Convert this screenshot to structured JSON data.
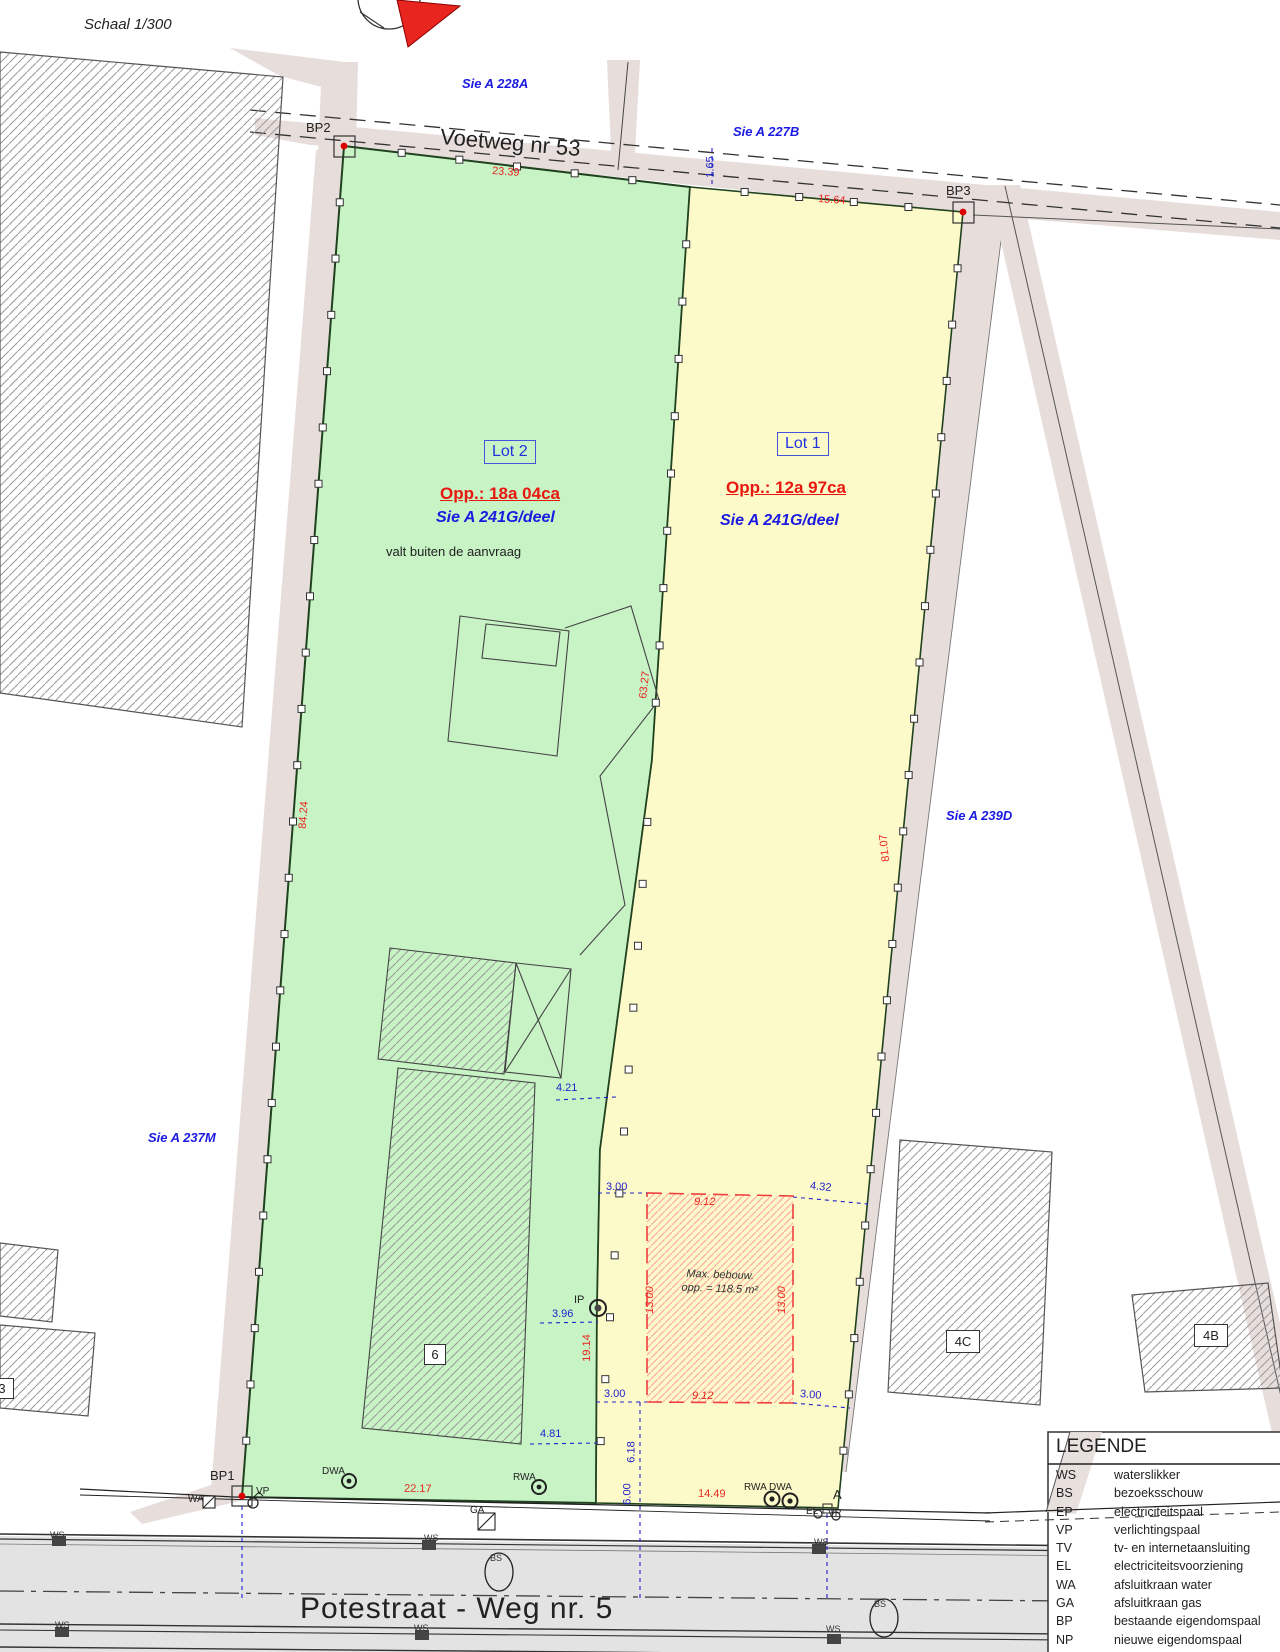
{
  "scale_note": "Schaal 1/300",
  "streets": {
    "voetweg": "Voetweg nr 53",
    "potestraat": "Potestraat - Weg nr. 5"
  },
  "adjacent_parcels": {
    "a228a": "Sie A 228A",
    "a227b": "Sie A 227B",
    "a239d": "Sie A 239D",
    "a237m": "Sie A 237M"
  },
  "lot2": {
    "name": "Lot 2",
    "area": "Opp.: 18a 04ca",
    "cadastre": "Sie A 241G/deel",
    "note": "valt buiten de aanvraag"
  },
  "lot1": {
    "name": "Lot 1",
    "area": "Opp.: 12a 97ca",
    "cadastre": "Sie A 241G/deel"
  },
  "benchmarks": {
    "bp1": "BP1",
    "bp2": "BP2",
    "bp3": "BP3",
    "a": "A",
    "ip": "IP"
  },
  "dims_red": {
    "top_green": "23.39",
    "top_yellow": "15.64",
    "left_edge": "84.24",
    "divider": "63.27",
    "right_edge": "81.07",
    "divider_low": "19.14",
    "box_left": "13.00",
    "box_right": "13.00",
    "box_top": "9.12",
    "box_bottom": "9.12",
    "bottom_green": "22.17",
    "bottom_yellow": "14.49"
  },
  "dims_blue": {
    "gap_165": "1.65",
    "top_left_300": "3.00",
    "top_right_432": "4.32",
    "bot_left_300": "3.00",
    "bot_right_300": "3.00",
    "d396": "3.96",
    "d421": "4.21",
    "d481": "4.81",
    "d618": "6.18",
    "d600": "6.00"
  },
  "max_build": {
    "line1": "Max. bebouw.",
    "line2": "opp. = 118.5 m²"
  },
  "building_labels": {
    "b6": "6",
    "b4c": "4C",
    "b4b": "4B",
    "b3": "3"
  },
  "utilities": {
    "wa": "WA",
    "vp": "VP",
    "dwa": "DWA",
    "rwa": "RWA",
    "ga": "GA",
    "rwadwa": "RWA DWA",
    "el": "EL",
    "vp2": "VP",
    "ws": "WS",
    "bs": "BS"
  },
  "legend": {
    "title": "LEGENDE",
    "rows": [
      {
        "code": "WS",
        "desc": "waterslikker"
      },
      {
        "code": "BS",
        "desc": "bezoeksschouw"
      },
      {
        "code": "EP",
        "desc": "electriciteitspaal"
      },
      {
        "code": "VP",
        "desc": "verlichtingspaal"
      },
      {
        "code": "TV",
        "desc": "tv- en internetaansluiting"
      },
      {
        "code": "EL",
        "desc": "electriciteitsvoorziening"
      },
      {
        "code": "WA",
        "desc": "afsluitkraan water"
      },
      {
        "code": "GA",
        "desc": "afsluitkraan gas"
      },
      {
        "code": "BP",
        "desc": "bestaande eigendomspaal"
      },
      {
        "code": "NP",
        "desc": "nieuwe eigendomspaal"
      },
      {
        "code": "AP",
        "desc": "afsluitingspaal"
      }
    ]
  },
  "colors": {
    "lot2_green": "#c7f3c5",
    "lot1_yellow": "#fcfac8",
    "road_beige": "#e7dedb",
    "road_gray": "#e3e3e3",
    "dim_red": "#e82520",
    "dim_blue": "#2222cc",
    "max_box_red": "#f04040",
    "north_red": "#e8251f"
  }
}
